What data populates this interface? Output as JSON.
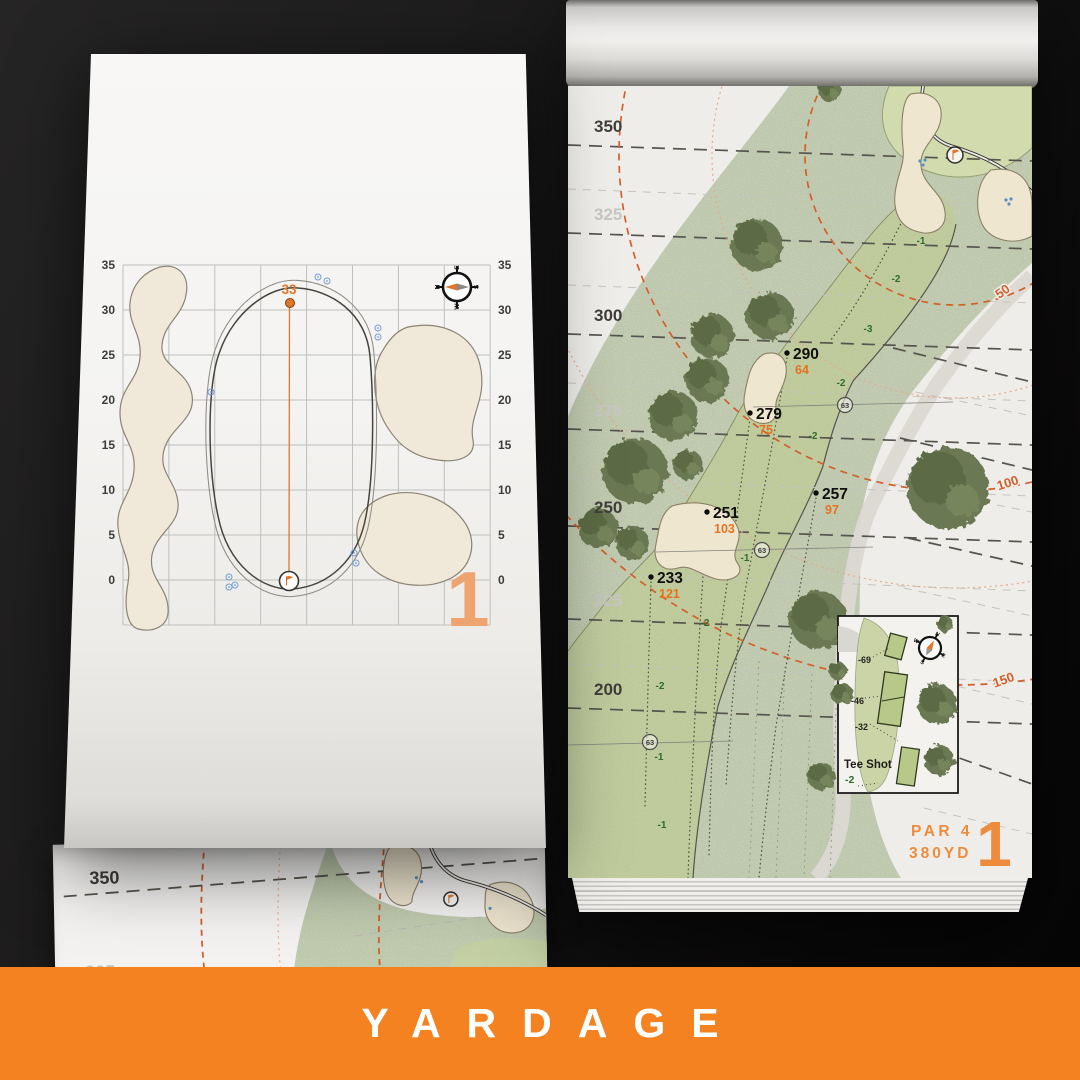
{
  "banner": {
    "label": "YARDAGE"
  },
  "colors": {
    "accent_orange": "#F58220",
    "map_orange": "#D2602B",
    "muted_orange": "#EFA470",
    "fairway_green": "#C8D3A4",
    "rough_green": "#CDD6BD",
    "sand": "#EFE6D4"
  },
  "left_page": {
    "hole_number": "1",
    "pin_distance": "33",
    "axis_labels": [
      "35",
      "30",
      "25",
      "20",
      "15",
      "10",
      "5",
      "0"
    ],
    "compass": {
      "n": "N",
      "e": "E",
      "s": "S",
      "w": "W"
    }
  },
  "right_page": {
    "hole_number": "1",
    "par": "PAR 4",
    "yardage": "380YD",
    "distance_lines": [
      {
        "label": "350",
        "tone": "dark"
      },
      {
        "label": "325",
        "tone": "light"
      },
      {
        "label": "300",
        "tone": "dark"
      },
      {
        "label": "275",
        "tone": "light"
      },
      {
        "label": "250",
        "tone": "dark"
      },
      {
        "label": "225",
        "tone": "light"
      },
      {
        "label": "200",
        "tone": "dark"
      }
    ],
    "arc_labels": [
      "50",
      "100",
      "150"
    ],
    "carry_points": [
      {
        "carry": "290",
        "remaining": "64"
      },
      {
        "carry": "279",
        "remaining": "75"
      },
      {
        "carry": "257",
        "remaining": "97"
      },
      {
        "carry": "251",
        "remaining": "103"
      },
      {
        "carry": "233",
        "remaining": "121"
      }
    ],
    "sprinkler_yardages": [
      "63",
      "63",
      "63"
    ],
    "elevation_marks": [
      "-1",
      "-2",
      "-3",
      "-2",
      "-2",
      "-1",
      "-2",
      "-2",
      "-1",
      "-1"
    ],
    "inset": {
      "title": "Tee Shot",
      "elevation": "-2",
      "tee_offsets": [
        "-69",
        "-46",
        "-32"
      ]
    },
    "compass": {
      "n": "N",
      "e": "E",
      "s": "S",
      "w": "W"
    }
  },
  "next_page": {
    "distance_labels": [
      "350",
      "325"
    ]
  }
}
